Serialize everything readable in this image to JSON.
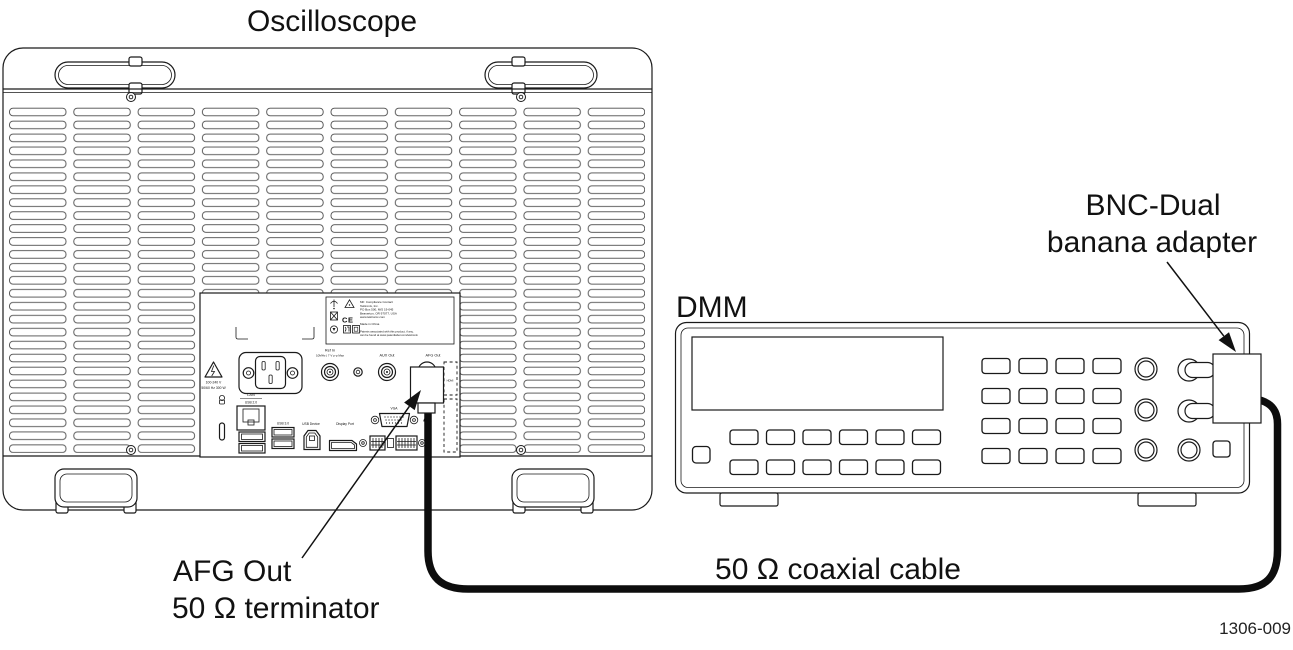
{
  "figure": {
    "title_oscilloscope": "Oscilloscope",
    "title_dmm": "DMM",
    "adapter_label": {
      "line1": "BNC-Dual",
      "line2": "banana adapter"
    },
    "terminator_label": {
      "line1": "AFG Out",
      "line2": "50 Ω terminator"
    },
    "cable_label": "50 Ω coaxial cable",
    "figure_number": "1306-009"
  },
  "oscilloscope_rear": {
    "power_warning": {
      "line1": "100-240 V",
      "line2": "50/60 Hz 300 W"
    },
    "ports": {
      "lan": "LAN",
      "usb2": "USB 2.0",
      "usb3": "USB 3.0",
      "usb_device": "USB Device",
      "display_port": "Display Port",
      "vga": "VGA",
      "hdmi": "HDMI",
      "ref_in_line1": "Ref In",
      "ref_in_line2": "10MHz | 7 V p-p Max",
      "aux_out": "AUX Out",
      "afg_out": "AFG Out"
    },
    "compliance_label": {
      "ce_mark": "CE",
      "contact_lines": [
        "Mfr. Compliance Contact",
        "Tektronix, Inc.",
        "PO Box 500, M/S 19-045",
        "Beaverton, OR 97077, USA",
        "www.tektronix.com"
      ],
      "made_in": "Made in China",
      "patents": [
        "Patents associated with this product, if any,",
        "can be found at www.patentlabel.com/tektronix"
      ]
    }
  },
  "colors": {
    "line": "#1a1a1a",
    "background": "#ffffff",
    "cable": "#0d0d0d"
  }
}
